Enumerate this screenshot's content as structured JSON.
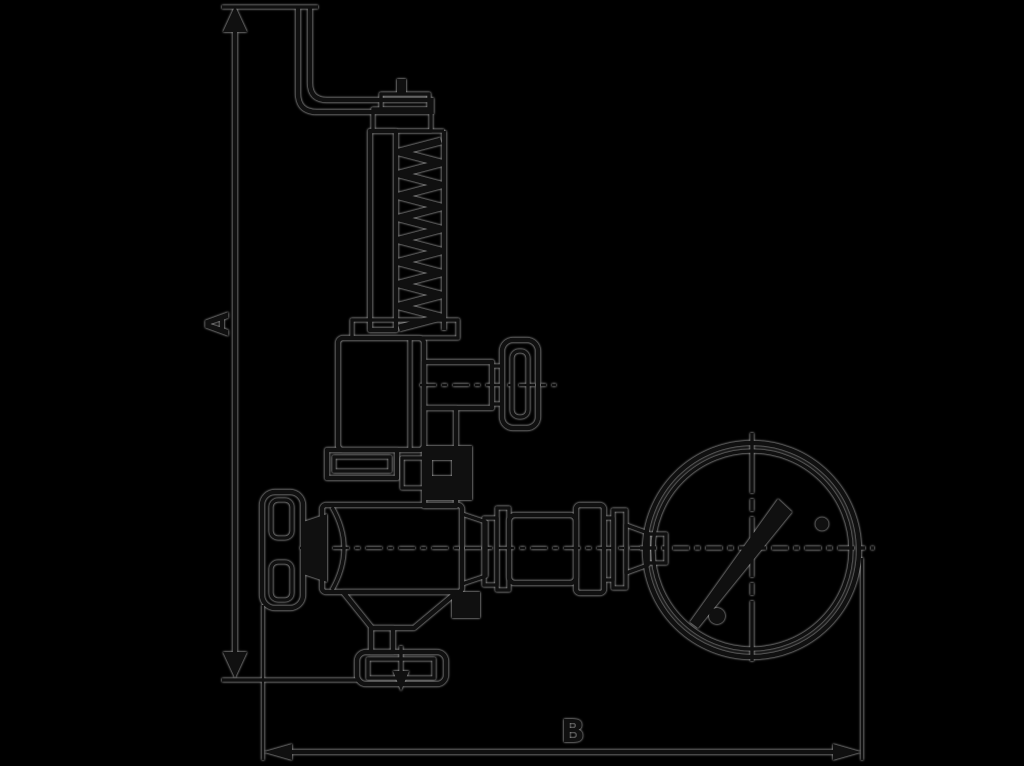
{
  "canvas": {
    "width": 1024,
    "height": 766,
    "background": "#000000"
  },
  "palette": {
    "ink": "#101010",
    "halo": "#c8c8c8"
  },
  "dimension_annotations": {
    "vertical": {
      "label": "A"
    },
    "horizontal": {
      "label": "B"
    }
  },
  "drawing": {
    "type": "technical-line-drawing",
    "subject": "safety relief valve with release lever, spring housing, handwheels, bottom outlet flange and pressure gauge",
    "components": [
      "release-lever",
      "adjusting-cap",
      "spring-housing",
      "spring-coil",
      "test-handwheel",
      "bonnet",
      "bonnet-flange",
      "inlet-handwheel",
      "valve-body",
      "outlet-neck",
      "outlet-flange",
      "flow-arrow",
      "gauge-connection",
      "pressure-gauge",
      "gauge-needle",
      "gauge-screws"
    ]
  }
}
